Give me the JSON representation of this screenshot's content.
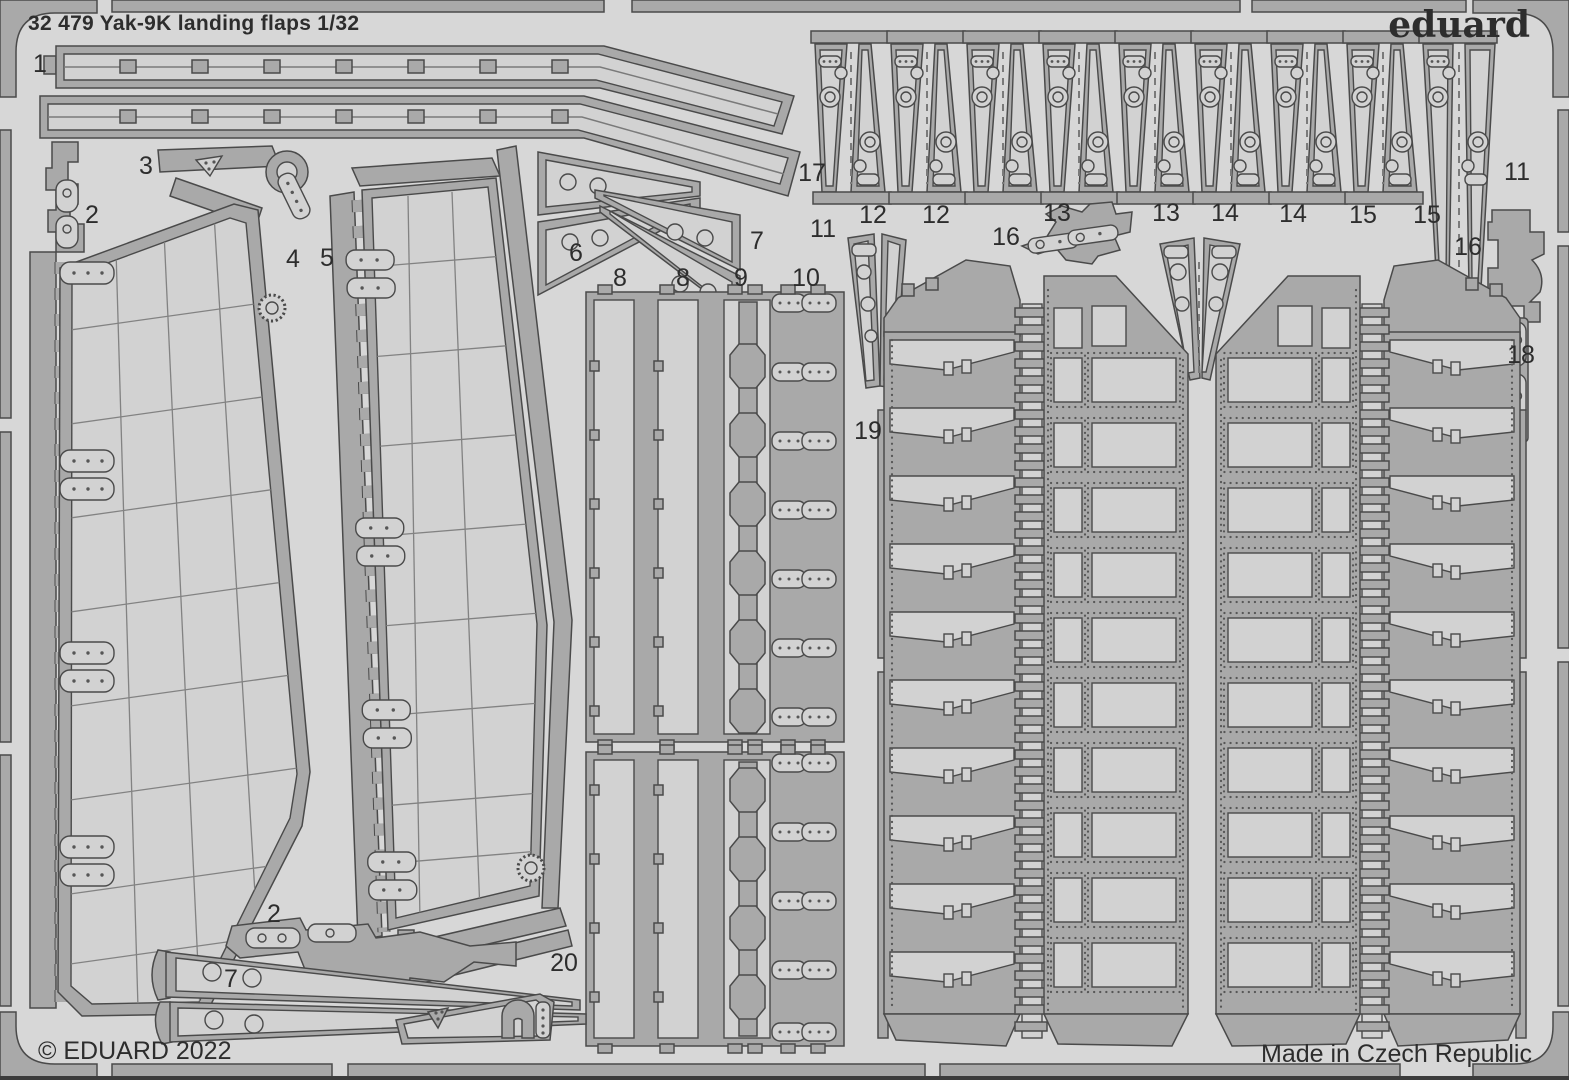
{
  "sheet": {
    "title": "32 479  Yak-9K landing flaps 1/32",
    "brand": "eduard",
    "copyright": "© EDUARD 2022",
    "made_in": "Made in Czech Republic"
  },
  "colors": {
    "background": "#d7d7d7",
    "metal": "#a9a9a9",
    "etched": "#d2d2d2",
    "outline": "#4a4a4a",
    "rivet": "#565656",
    "text": "#2d2d2d"
  },
  "part_labels": [
    {
      "text": "1",
      "x": 40,
      "y": 63
    },
    {
      "text": "3",
      "x": 146,
      "y": 165
    },
    {
      "text": "2",
      "x": 92,
      "y": 214
    },
    {
      "text": "4",
      "x": 293,
      "y": 258
    },
    {
      "text": "5",
      "x": 327,
      "y": 257
    },
    {
      "text": "6",
      "x": 576,
      "y": 252
    },
    {
      "text": "7",
      "x": 757,
      "y": 240
    },
    {
      "text": "17",
      "x": 812,
      "y": 172
    },
    {
      "text": "8",
      "x": 620,
      "y": 277
    },
    {
      "text": "8",
      "x": 683,
      "y": 277
    },
    {
      "text": "9",
      "x": 741,
      "y": 277
    },
    {
      "text": "10",
      "x": 806,
      "y": 277
    },
    {
      "text": "11",
      "x": 823,
      "y": 228
    },
    {
      "text": "12",
      "x": 873,
      "y": 214
    },
    {
      "text": "12",
      "x": 936,
      "y": 214
    },
    {
      "text": "13",
      "x": 1057,
      "y": 212
    },
    {
      "text": "13",
      "x": 1166,
      "y": 212
    },
    {
      "text": "14",
      "x": 1225,
      "y": 212
    },
    {
      "text": "14",
      "x": 1293,
      "y": 213
    },
    {
      "text": "15",
      "x": 1363,
      "y": 214
    },
    {
      "text": "15",
      "x": 1427,
      "y": 214
    },
    {
      "text": "11",
      "x": 1517,
      "y": 171
    },
    {
      "text": "16",
      "x": 1006,
      "y": 236
    },
    {
      "text": "16",
      "x": 1468,
      "y": 246
    },
    {
      "text": "18",
      "x": 1521,
      "y": 354
    },
    {
      "text": "19",
      "x": 868,
      "y": 430
    },
    {
      "text": "2",
      "x": 274,
      "y": 913
    },
    {
      "text": "7",
      "x": 231,
      "y": 978
    },
    {
      "text": "20",
      "x": 564,
      "y": 962
    }
  ]
}
